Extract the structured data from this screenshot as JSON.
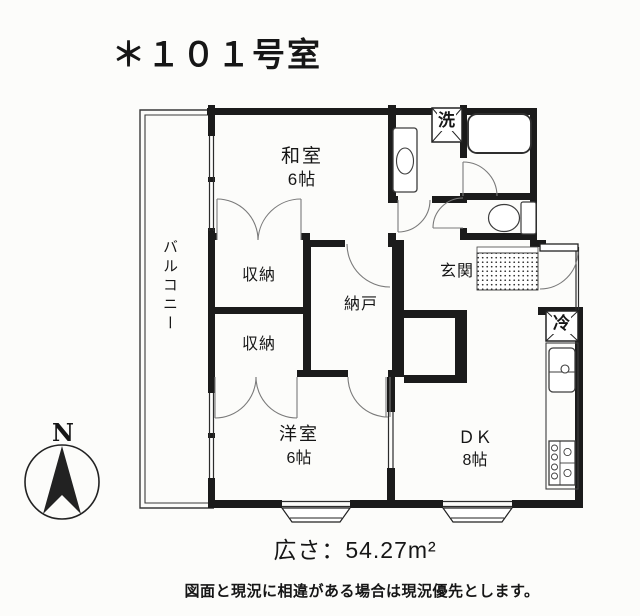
{
  "title": "＊１０１号室",
  "compass": {
    "north_label": "N"
  },
  "rooms": {
    "balcony": "バルコニー",
    "japanese_room": "和室",
    "japanese_room_size": "6帖",
    "storage_upper": "収納",
    "storage_lower": "収納",
    "storeroom": "納戸",
    "entrance": "玄関",
    "western_room": "洋室",
    "western_room_size": "6帖",
    "dining_kitchen": "ＤＫ",
    "dining_kitchen_size": "8帖"
  },
  "fixtures": {
    "washing_machine": "洗",
    "refrigerator": "冷"
  },
  "footer": {
    "area": "広さ：54.27m²",
    "disclaimer": "図面と現況に相違がある場合は現況優先とします。"
  },
  "colors": {
    "ink": "#1b1b1b",
    "paper": "#fcfcfa",
    "door_arc": "#7a7a7a"
  }
}
